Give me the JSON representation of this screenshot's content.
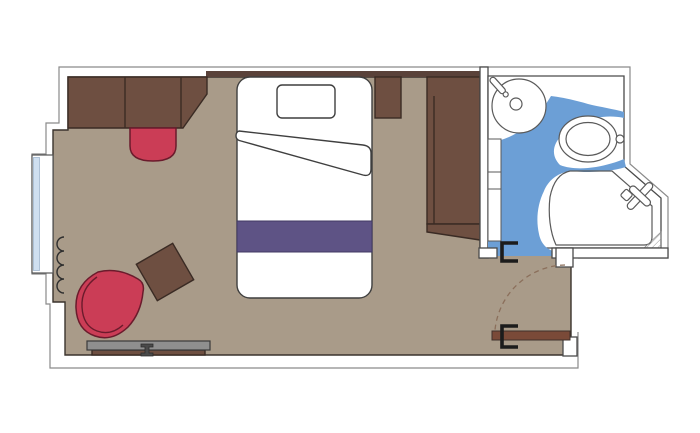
{
  "floorplan": {
    "name": "cruise-ship-cabin-floor-plan",
    "colors": {
      "background": "#ffffff",
      "cabin_floor": "#a99b89",
      "bathroom_floor": "#6c9fd6",
      "furniture_brown": "#6e4f41",
      "wall_trim": "#5a423a",
      "accent_red": "#cb3d56",
      "runner_purple": "#5e5385",
      "desk_gray": "#8f8f8f",
      "door_brown": "#7a4a38",
      "window_glass": "#cfdff0",
      "wall_outline": "#4a4a4a",
      "outer_outline": "#8a8a8a",
      "bracket_black": "#1c1c1c",
      "swing_arc": "#8b6f5b"
    },
    "rooms": [
      {
        "name": "cabin",
        "floor_color_key": "cabin_floor"
      },
      {
        "name": "bathroom",
        "floor_color_key": "bathroom_floor"
      }
    ],
    "elements": [
      "sofa",
      "vanity-stool",
      "bed",
      "pillow",
      "folded-sheet",
      "bed-runner",
      "nightstand",
      "wardrobe",
      "armchair",
      "side-table",
      "wall-desk",
      "curtain",
      "window",
      "entry-door",
      "door-swing-arc",
      "sink",
      "faucet",
      "toilet",
      "flush-button",
      "shower-tray",
      "shower-head",
      "shelves",
      "drain-mat",
      "bathroom-door-bracket",
      "entry-door-bracket"
    ]
  }
}
